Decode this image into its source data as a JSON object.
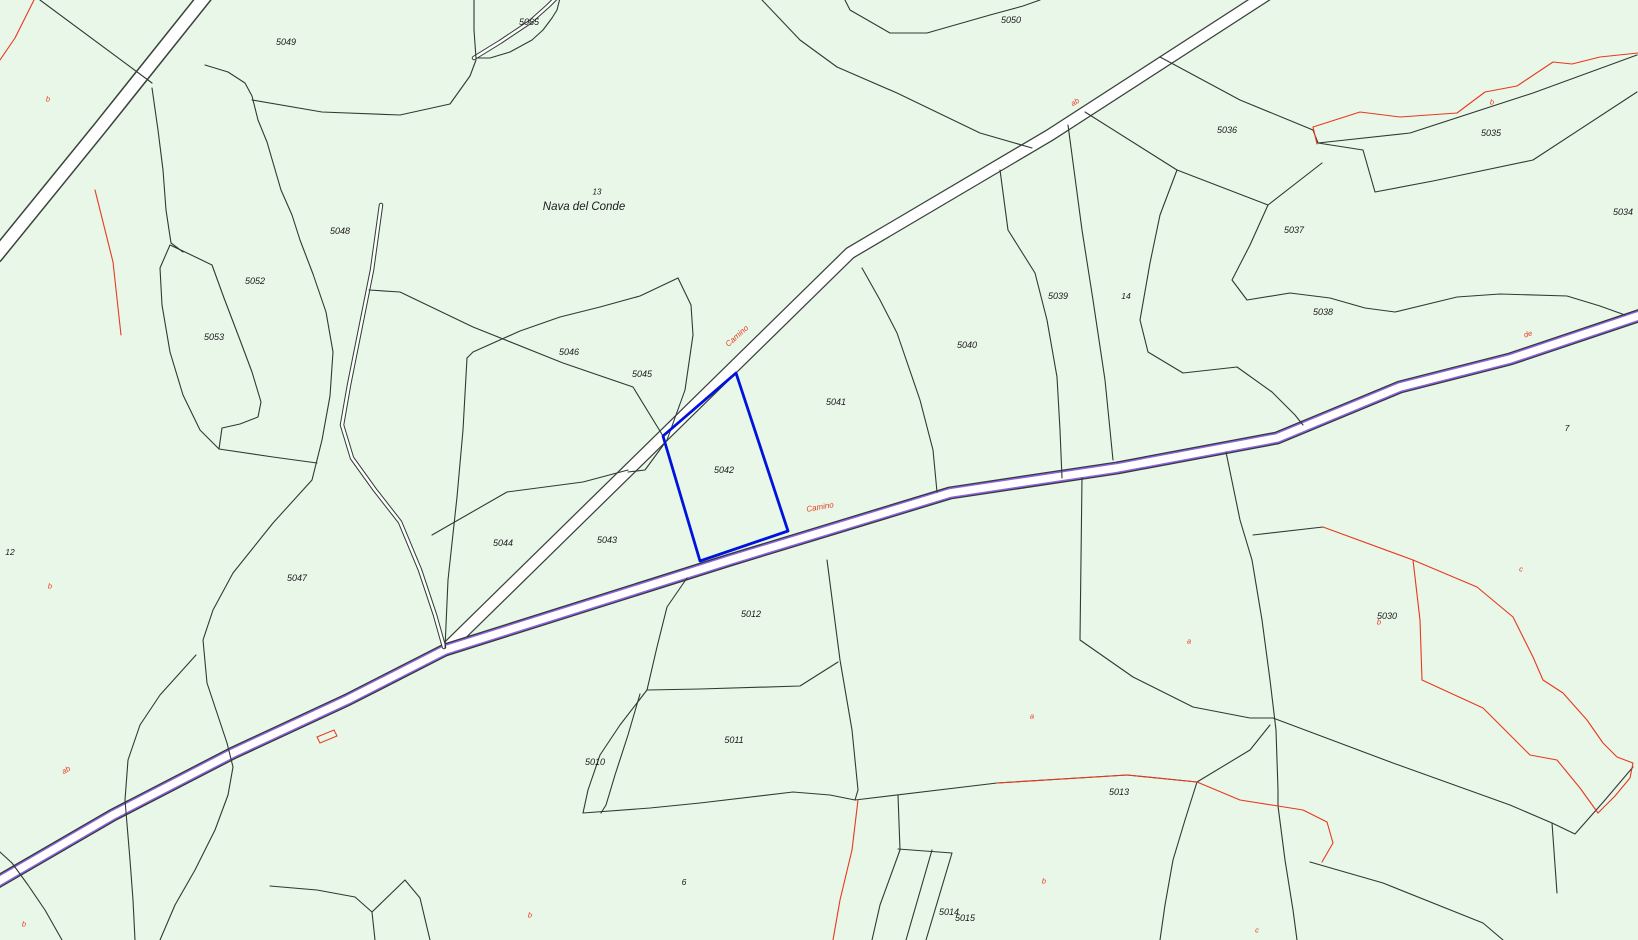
{
  "map": {
    "title": "Cadastral parcel map",
    "selected_parcel_id": "5042",
    "place": {
      "upper": "13",
      "name": "Nava del Conde",
      "x": 584,
      "y": 200
    },
    "colors": {
      "background": "#e9f7e9",
      "boundary": "#2f3a33",
      "red_boundary": "#e8391d",
      "road_edge": "#3a423c",
      "road_purple": "#8f62e3",
      "road_fill": "#ffffff",
      "selected_blue": "#0013dc",
      "label_black": "#1a1a1a"
    },
    "selected_parcel": {
      "id": "5042",
      "points": "736,373 663,436 700,561 788,531"
    },
    "roads": [
      {
        "name": "road-upper-left",
        "d": "M207,-6 L100,128 L-4,256",
        "strokes": [
          {
            "c": "#3a423c",
            "w": 15
          },
          {
            "c": "#ffffff",
            "w": 12
          }
        ]
      },
      {
        "name": "road-camino-diagonal",
        "d": "M1268,-6 L1050,135 L850,253 L700,400 L445,650",
        "strokes": [
          {
            "c": "#3a423c",
            "w": 13
          },
          {
            "c": "#ffffff",
            "w": 10.5
          }
        ]
      },
      {
        "name": "road-camino-purple",
        "d": "M-6,884 L113,815 L233,753 L347,700 L445,650 L730,560 L950,493 L1117,468 L1277,438 L1400,387 L1510,359 L1644,314",
        "strokes": [
          {
            "c": "#2f3a33",
            "w": 13
          },
          {
            "c": "#8f62e3",
            "w": 10.5
          },
          {
            "c": "#ffffff",
            "w": 7.5
          }
        ]
      }
    ],
    "streams": [
      {
        "name": "stream-sliver",
        "d": "M381,205 L372,270 L360,330 L349,385 L342,425 L352,458 L375,490 L400,522 L420,570 L435,615 L444,647",
        "strokes": [
          {
            "c": "#2f3a33",
            "w": 4.5
          },
          {
            "c": "#ffffff",
            "w": 2.5
          }
        ]
      },
      {
        "name": "stream-leaf",
        "d": "M474,58 L500,42 L530,22 L548,6 L556,-2",
        "strokes": [
          {
            "c": "#2f3a33",
            "w": 4.5
          },
          {
            "c": "#ffffff",
            "w": 2.5
          }
        ]
      }
    ],
    "black_lines": [
      "M40,0 L152,83",
      "M205,65 L228,72 L245,83 L252,96 L258,120 L267,142 L281,190 L292,215 L300,240 L313,274 L326,312 L333,352 L330,396 L322,440 L312,480 L273,523 L233,573 L213,610 L203,640 L207,683 L217,713 L227,743 L233,767 L228,795 L215,830 L195,870 L175,905 L160,940",
      "M196,655 L160,695 L140,725 L128,760 L125,800 L130,860 L133,900 L135,940",
      "M62,940 L45,910 L28,885 L12,863 L0,852",
      "M152,88 L158,130 L163,170 L166,210 L171,243 L183,252",
      "M185,252 L212,265 L224,298 L240,340 L252,372 L261,402 L258,417 L240,424 L222,428 L219,449 L200,430 L183,395 L170,352 L162,305 L160,268 L170,245 Z",
      "M219,449 L273,457 L317,463",
      "M252,100 L322,112 L400,115 L450,104 L470,76 L476,60",
      "M762,0 L800,40 L837,67 L897,93 L980,133 L1032,148",
      "M845,0 L850,10 L890,33 L927,33 L990,15 L1023,6 L1040,0",
      "M474,-2 L474,30 L476,58 L490,58 L510,52 L532,40 L543,30 L552,18 L557,10 L560,-2",
      "M678,278 L640,296 L600,307 L560,317 L520,331 L473,352 L467,358",
      "M369,290 L400,292 L473,327 L563,363 L633,387 L663,436",
      "M467,358 L463,430 L457,497 L448,580 L445,648",
      "M432,535 L507,492 L583,482 L628,470",
      "M678,278 L691,305 L693,335 L685,390 L667,440 L645,470 L628,472",
      "M862,268 L880,300 L897,333 L920,400 L933,450 L937,492",
      "M1000,170 L1008,230 L1035,273 L1047,320 L1057,377 L1060,430 L1062,478",
      "M1068,125 L1082,230 L1093,300 L1105,380 L1113,460",
      "M1177,170 L1160,215 L1150,263 L1140,320 L1148,352 L1183,373 L1237,367 L1272,392 L1295,415 L1303,425",
      "M1160,57 L1240,100 L1313,130",
      "M1313,130 L1318,143",
      "M1318,143 L1410,133 L1533,93 L1637,55",
      "M1318,143 L1363,150 L1375,192 L1433,181 L1533,160 L1637,92",
      "M1085,112 L1177,170 L1268,205 L1322,163",
      "M1268,205 L1250,245 L1232,280 L1247,300 L1290,293 L1330,298 L1365,308 L1395,312 L1457,297 L1500,294 L1567,296 L1600,306 L1625,315",
      "M1226,452 L1240,520 L1252,560 L1262,620 L1270,680 L1276,730 L1278,790 L1278,806 L1285,860 L1293,910 L1297,940",
      "M1253,535 L1323,527",
      "M1082,478 L1080,640 L1133,677 L1193,707 L1250,718 L1273,718",
      "M1273,718 L1393,763 L1510,805 L1552,823 L1575,834 L1605,800 L1633,767",
      "M1310,862 L1383,883 L1483,923 L1503,940",
      "M1552,823 L1557,893",
      "M855,800 L997,783 L1127,775 L1197,782 L1250,750 L1270,725",
      "M827,560 L840,660 L852,730 L858,790 L855,800",
      "M687,578 L667,607 L657,647 L647,690",
      "M647,690 L700,689 L800,686 L838,662",
      "M647,690 L620,725 L600,755 L588,790 L583,813",
      "M640,694 L628,735 L615,775 L606,805 L601,813",
      "M583,813 L650,808 L700,803 L793,792 L830,795 L855,800",
      "M898,795 L900,850 L880,905 L872,940",
      "M898,849 L952,853",
      "M932,850 L906,940",
      "M952,853 L926,940",
      "M1197,782 L1185,820 L1173,860 L1165,905 L1160,940",
      "M270,886 L317,890 L355,897 L372,912 L375,940",
      "M372,912 L405,880 L420,898 L430,940"
    ],
    "red_lines": [
      "M34,0 L15,38 L0,60",
      "M95,190 L113,262 L121,335",
      "M1313,127 L1360,112 L1400,117 L1457,113 L1485,92 L1517,86 L1553,62 L1572,64 L1600,57 L1638,53",
      "M1313,127 L1317,144",
      "M1323,527 L1413,560 L1477,587 L1513,617 L1533,657 L1543,680 L1563,693 L1587,720 L1603,743 L1617,757 L1633,763 L1630,778 L1615,796 L1598,813",
      "M1413,560 L1420,620 L1422,680 L1483,708 L1530,755 L1557,760 L1580,788 L1598,813",
      "M997,783 L1127,775 L1197,782",
      "M1197,782 L1240,800 L1278,806 L1303,810 L1327,822 L1333,843 L1322,862",
      "M858,800 L852,850 L840,900 L833,940"
    ],
    "building": {
      "name": "building-outline",
      "points": "317,737 334,730 337,736 320,743"
    },
    "parcel_labels": [
      {
        "text": "5065",
        "x": 529,
        "y": 22,
        "size": 9
      },
      {
        "text": "5049",
        "x": 286,
        "y": 42,
        "size": 9
      },
      {
        "text": "5050",
        "x": 1011,
        "y": 20,
        "size": 9
      },
      {
        "text": "5036",
        "x": 1227,
        "y": 130,
        "size": 9
      },
      {
        "text": "5035",
        "x": 1491,
        "y": 133,
        "size": 9
      },
      {
        "text": "5034",
        "x": 1623,
        "y": 212,
        "size": 9
      },
      {
        "text": "5037",
        "x": 1294,
        "y": 230,
        "size": 9
      },
      {
        "text": "5038",
        "x": 1323,
        "y": 312,
        "size": 9
      },
      {
        "text": "5048",
        "x": 340,
        "y": 231,
        "size": 9
      },
      {
        "text": "5052",
        "x": 255,
        "y": 281,
        "size": 9
      },
      {
        "text": "5053",
        "x": 214,
        "y": 337,
        "size": 9
      },
      {
        "text": "5046",
        "x": 569,
        "y": 352,
        "size": 9
      },
      {
        "text": "5045",
        "x": 642,
        "y": 374,
        "size": 9
      },
      {
        "text": "5041",
        "x": 836,
        "y": 402,
        "size": 9
      },
      {
        "text": "5040",
        "x": 967,
        "y": 345,
        "size": 9
      },
      {
        "text": "5039",
        "x": 1058,
        "y": 296,
        "size": 9
      },
      {
        "text": "14",
        "x": 1126,
        "y": 296,
        "size": 8.5
      },
      {
        "text": "5030",
        "x": 1387,
        "y": 616,
        "size": 9
      },
      {
        "text": "7",
        "x": 1567,
        "y": 428,
        "size": 8.5
      },
      {
        "text": "5042",
        "x": 724,
        "y": 470,
        "size": 9
      },
      {
        "text": "5043",
        "x": 607,
        "y": 540,
        "size": 9
      },
      {
        "text": "5044",
        "x": 503,
        "y": 543,
        "size": 9
      },
      {
        "text": "5047",
        "x": 297,
        "y": 578,
        "size": 9
      },
      {
        "text": "12",
        "x": 10,
        "y": 552,
        "size": 8.5
      },
      {
        "text": "5012",
        "x": 751,
        "y": 614,
        "size": 9
      },
      {
        "text": "5011",
        "x": 734,
        "y": 740,
        "size": 9
      },
      {
        "text": "5010",
        "x": 595,
        "y": 762,
        "size": 9
      },
      {
        "text": "6",
        "x": 684,
        "y": 882,
        "size": 8.5
      },
      {
        "text": "5013",
        "x": 1119,
        "y": 792,
        "size": 9
      },
      {
        "text": "5014",
        "x": 949,
        "y": 912,
        "size": 9
      },
      {
        "text": "5015",
        "x": 965,
        "y": 918,
        "size": 9
      }
    ],
    "red_labels": [
      {
        "text": "b",
        "x": 48,
        "y": 99,
        "rot": 0,
        "size": 7.5
      },
      {
        "text": "b",
        "x": 1492,
        "y": 102,
        "rot": 0,
        "size": 7.5
      },
      {
        "text": "ab",
        "x": 1075,
        "y": 102,
        "rot": -32,
        "size": 7.5
      },
      {
        "text": "Camino",
        "x": 737,
        "y": 336,
        "rot": -42,
        "size": 8
      },
      {
        "text": "Camino",
        "x": 820,
        "y": 507,
        "rot": -10,
        "size": 8
      },
      {
        "text": "de",
        "x": 1528,
        "y": 334,
        "rot": -18,
        "size": 7.5
      },
      {
        "text": "b",
        "x": 50,
        "y": 586,
        "rot": 0,
        "size": 7.5
      },
      {
        "text": "ab",
        "x": 66,
        "y": 770,
        "rot": -30,
        "size": 7.5
      },
      {
        "text": "b",
        "x": 24,
        "y": 924,
        "rot": 0,
        "size": 7.5
      },
      {
        "text": "b",
        "x": 530,
        "y": 915,
        "rot": 0,
        "size": 7.5
      },
      {
        "text": "a",
        "x": 1189,
        "y": 641,
        "rot": 0,
        "size": 7.5
      },
      {
        "text": "a",
        "x": 1032,
        "y": 716,
        "rot": 0,
        "size": 7.5
      },
      {
        "text": "b",
        "x": 1044,
        "y": 881,
        "rot": 0,
        "size": 7.5
      },
      {
        "text": "c",
        "x": 1257,
        "y": 930,
        "rot": 0,
        "size": 7.5
      },
      {
        "text": "c",
        "x": 1521,
        "y": 569,
        "rot": 0,
        "size": 7.5
      },
      {
        "text": "b",
        "x": 1379,
        "y": 622,
        "rot": 0,
        "size": 7.5
      }
    ]
  }
}
